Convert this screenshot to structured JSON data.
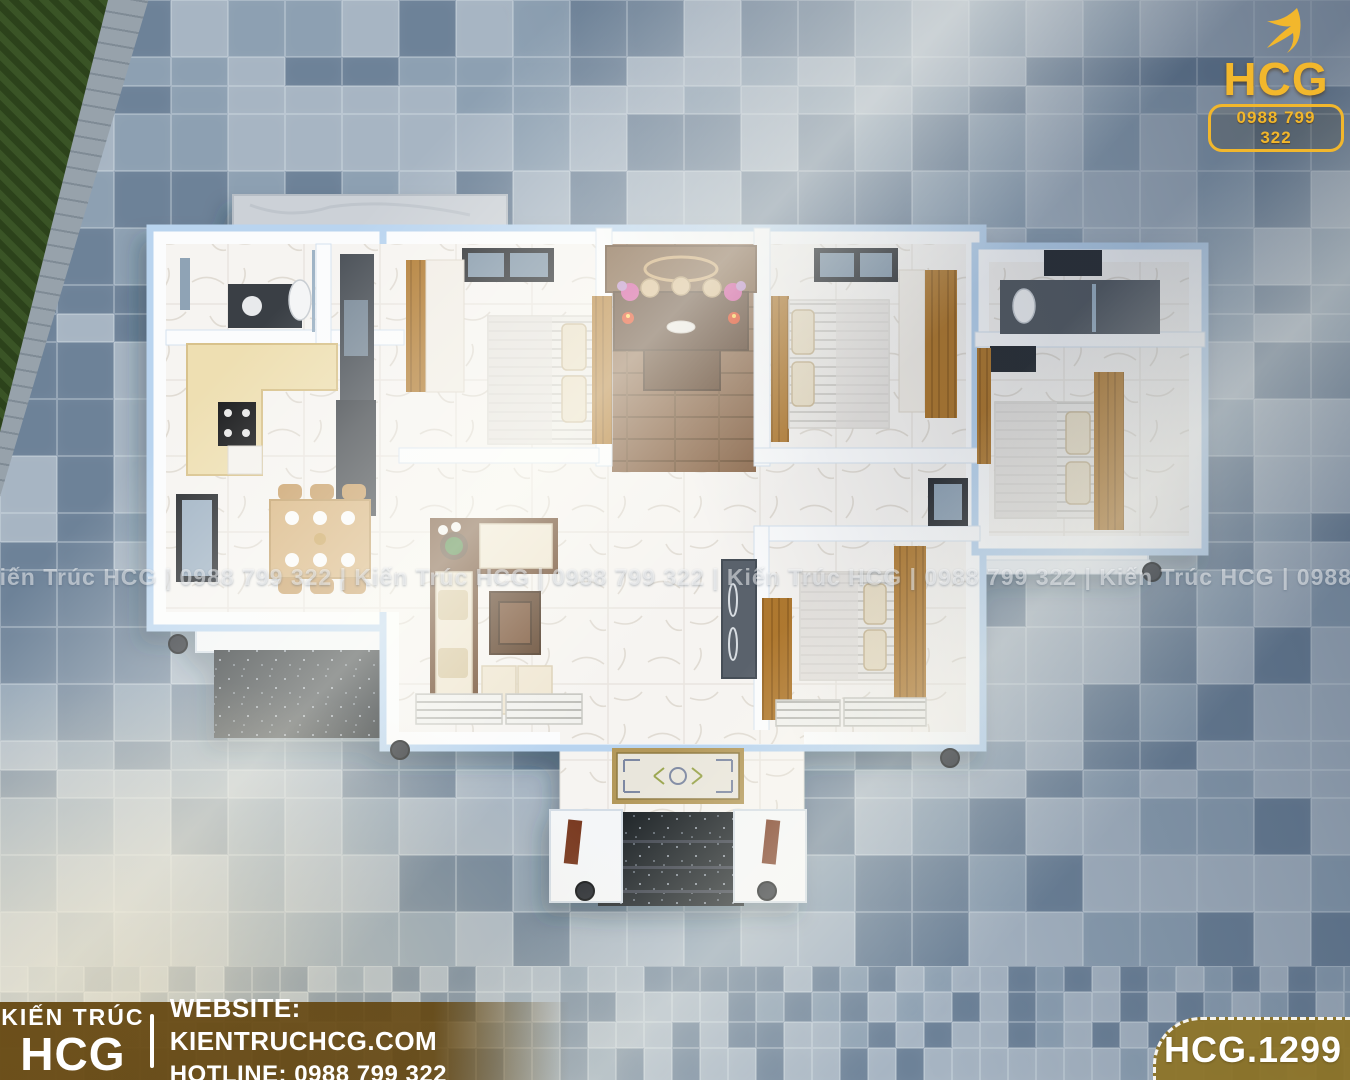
{
  "watermark": {
    "line": "Kiến Trúc HCG   |   0988 799 322   |   Kiến Trúc HCG   |   0988 799 322   |   Kiến Trúc HCG   |   0988 799 322   |   Kiến Trúc HCG   |   0988 799 322"
  },
  "logo": {
    "name": "HCG",
    "phone": "0988 799 322"
  },
  "footer": {
    "brand_top": "KIẾN TRÚC",
    "brand_bottom": "HCG",
    "website_label": "WEBSITE:",
    "website_value": "KIENTRUCHCG.COM",
    "hotline_label": "HOTLINE:",
    "hotline_value": "0988 799 322"
  },
  "badge": {
    "code": "HCG.1299"
  },
  "colors": {
    "gold": "#f2b72c",
    "brown_bar": "#63440c",
    "badge_gold": "#8c7326",
    "tile_light": "#a7b5c3",
    "tile_mid": "#8da0b2",
    "tile_dark": "#6d8298",
    "tile_grout": "#dfe7ee",
    "grass": "#3a5426",
    "granite": "#1d2127",
    "wall_white": "#fbfcfd",
    "wall_glow": "#b9d4ef",
    "wood": "#b0792f",
    "wood_floor": "#8a6648",
    "marble": "#f6f4f1"
  }
}
